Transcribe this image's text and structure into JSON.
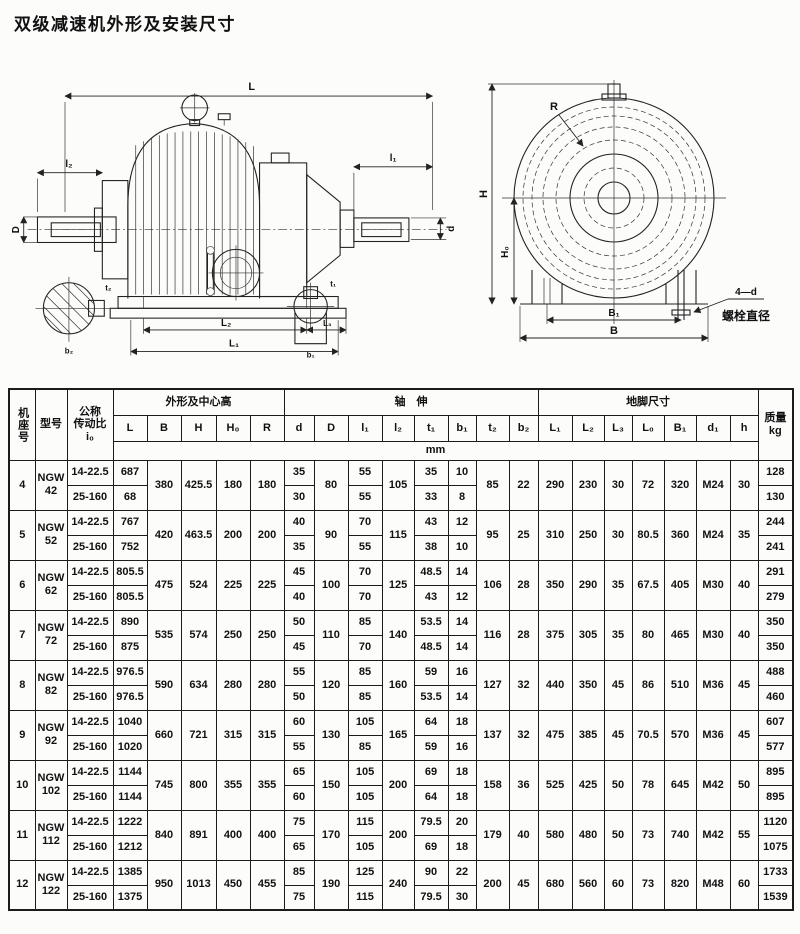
{
  "page": {
    "title": "双级减速机外形及安装尺寸"
  },
  "diagram": {
    "side_view": {
      "L": "L",
      "l2": "l₂",
      "D": "D",
      "l1": "l₁",
      "d": "d",
      "L2_dim": "L₂",
      "L3_dim": "L₃",
      "L1_dim": "L₁",
      "t2_detail": "t₂",
      "b2_detail": "b₂",
      "t1_detail": "t₁",
      "b1_detail": "b₁"
    },
    "front_view": {
      "R": "R",
      "H": "H",
      "H0": "H₀",
      "B1": "B₁",
      "B": "B",
      "bolt_count": "4—d",
      "bolt_caption": "螺栓直径"
    }
  },
  "table": {
    "header": {
      "frame_no": "机座号",
      "model": "型号",
      "ratio": "公称\n传动比\ni₀",
      "outline_group": "外形及中心高",
      "shaft_group": "轴　伸",
      "foot_group": "地脚尺寸",
      "mass": "质量\nkg",
      "unit_row": "mm",
      "cols": [
        "L",
        "B",
        "H",
        "H₀",
        "R",
        "d",
        "D",
        "l₁",
        "l₂",
        "t₁",
        "b₁",
        "t₂",
        "b₂",
        "L₁",
        "L₂",
        "L₃",
        "L₀",
        "B₁",
        "d₁",
        "h"
      ]
    },
    "rows": [
      {
        "no": "4",
        "model": "NGW\n42",
        "sub": [
          {
            "ratio": "14-22.5",
            "L": "687",
            "d": "35",
            "l1": "55",
            "t1": "35",
            "b1": "10",
            "mass": "128"
          },
          {
            "ratio": "25-160",
            "L": "68",
            "d": "30",
            "l1": "55",
            "t1": "33",
            "b1": "8",
            "mass": "130"
          }
        ],
        "B": "380",
        "H": "425.5",
        "H0": "180",
        "R": "180",
        "D": "80",
        "l2": "105",
        "t2": "85",
        "b2": "22",
        "L1": "290",
        "L2": "230",
        "L3": "30",
        "L0": "72",
        "B1": "320",
        "d1": "M24",
        "h": "30"
      },
      {
        "no": "5",
        "model": "NGW\n52",
        "sub": [
          {
            "ratio": "14-22.5",
            "L": "767",
            "d": "40",
            "l1": "70",
            "t1": "43",
            "b1": "12",
            "mass": "244"
          },
          {
            "ratio": "25-160",
            "L": "752",
            "d": "35",
            "l1": "55",
            "t1": "38",
            "b1": "10",
            "mass": "241"
          }
        ],
        "B": "420",
        "H": "463.5",
        "H0": "200",
        "R": "200",
        "D": "90",
        "l2": "115",
        "t2": "95",
        "b2": "25",
        "L1": "310",
        "L2": "250",
        "L3": "30",
        "L0": "80.5",
        "B1": "360",
        "d1": "M24",
        "h": "35"
      },
      {
        "no": "6",
        "model": "NGW\n62",
        "sub": [
          {
            "ratio": "14-22.5",
            "L": "805.5",
            "d": "45",
            "l1": "70",
            "t1": "48.5",
            "b1": "14",
            "mass": "291"
          },
          {
            "ratio": "25-160",
            "L": "805.5",
            "d": "40",
            "l1": "70",
            "t1": "43",
            "b1": "12",
            "mass": "279"
          }
        ],
        "B": "475",
        "H": "524",
        "H0": "225",
        "R": "225",
        "D": "100",
        "l2": "125",
        "t2": "106",
        "b2": "28",
        "L1": "350",
        "L2": "290",
        "L3": "35",
        "L0": "67.5",
        "B1": "405",
        "d1": "M30",
        "h": "40"
      },
      {
        "no": "7",
        "model": "NGW\n72",
        "sub": [
          {
            "ratio": "14-22.5",
            "L": "890",
            "d": "50",
            "l1": "85",
            "t1": "53.5",
            "b1": "14",
            "mass": "350"
          },
          {
            "ratio": "25-160",
            "L": "875",
            "d": "45",
            "l1": "70",
            "t1": "48.5",
            "b1": "14",
            "mass": "350"
          }
        ],
        "B": "535",
        "H": "574",
        "H0": "250",
        "R": "250",
        "D": "110",
        "l2": "140",
        "t2": "116",
        "b2": "28",
        "L1": "375",
        "L2": "305",
        "L3": "35",
        "L0": "80",
        "B1": "465",
        "d1": "M30",
        "h": "40"
      },
      {
        "no": "8",
        "model": "NGW\n82",
        "sub": [
          {
            "ratio": "14-22.5",
            "L": "976.5",
            "d": "55",
            "l1": "85",
            "t1": "59",
            "b1": "16",
            "mass": "488"
          },
          {
            "ratio": "25-160",
            "L": "976.5",
            "d": "50",
            "l1": "85",
            "t1": "53.5",
            "b1": "14",
            "mass": "460"
          }
        ],
        "B": "590",
        "H": "634",
        "H0": "280",
        "R": "280",
        "D": "120",
        "l2": "160",
        "t2": "127",
        "b2": "32",
        "L1": "440",
        "L2": "350",
        "L3": "45",
        "L0": "86",
        "B1": "510",
        "d1": "M36",
        "h": "45"
      },
      {
        "no": "9",
        "model": "NGW\n92",
        "sub": [
          {
            "ratio": "14-22.5",
            "L": "1040",
            "d": "60",
            "l1": "105",
            "t1": "64",
            "b1": "18",
            "mass": "607"
          },
          {
            "ratio": "25-160",
            "L": "1020",
            "d": "55",
            "l1": "85",
            "t1": "59",
            "b1": "16",
            "mass": "577"
          }
        ],
        "B": "660",
        "H": "721",
        "H0": "315",
        "R": "315",
        "D": "130",
        "l2": "165",
        "t2": "137",
        "b2": "32",
        "L1": "475",
        "L2": "385",
        "L3": "45",
        "L0": "70.5",
        "B1": "570",
        "d1": "M36",
        "h": "45"
      },
      {
        "no": "10",
        "model": "NGW\n102",
        "sub": [
          {
            "ratio": "14-22.5",
            "L": "1144",
            "d": "65",
            "l1": "105",
            "t1": "69",
            "b1": "18",
            "mass": "895"
          },
          {
            "ratio": "25-160",
            "L": "1144",
            "d": "60",
            "l1": "105",
            "t1": "64",
            "b1": "18",
            "mass": "895"
          }
        ],
        "B": "745",
        "H": "800",
        "H0": "355",
        "R": "355",
        "D": "150",
        "l2": "200",
        "t2": "158",
        "b2": "36",
        "L1": "525",
        "L2": "425",
        "L3": "50",
        "L0": "78",
        "B1": "645",
        "d1": "M42",
        "h": "50"
      },
      {
        "no": "11",
        "model": "NGW\n112",
        "sub": [
          {
            "ratio": "14-22.5",
            "L": "1222",
            "d": "75",
            "l1": "115",
            "t1": "79.5",
            "b1": "20",
            "mass": "1120"
          },
          {
            "ratio": "25-160",
            "L": "1212",
            "d": "65",
            "l1": "105",
            "t1": "69",
            "b1": "18",
            "mass": "1075"
          }
        ],
        "B": "840",
        "H": "891",
        "H0": "400",
        "R": "400",
        "D": "170",
        "l2": "200",
        "t2": "179",
        "b2": "40",
        "L1": "580",
        "L2": "480",
        "L3": "50",
        "L0": "73",
        "B1": "740",
        "d1": "M42",
        "h": "55"
      },
      {
        "no": "12",
        "model": "NGW\n122",
        "sub": [
          {
            "ratio": "14-22.5",
            "L": "1385",
            "d": "85",
            "l1": "125",
            "t1": "90",
            "b1": "22",
            "mass": "1733"
          },
          {
            "ratio": "25-160",
            "L": "1375",
            "d": "75",
            "l1": "115",
            "t1": "79.5",
            "b1": "30",
            "mass": "1539"
          }
        ],
        "B": "950",
        "H": "1013",
        "H0": "450",
        "R": "455",
        "D": "190",
        "l2": "240",
        "t2": "200",
        "b2": "45",
        "L1": "680",
        "L2": "560",
        "L3": "60",
        "L0": "73",
        "B1": "820",
        "d1": "M48",
        "h": "60"
      }
    ]
  }
}
